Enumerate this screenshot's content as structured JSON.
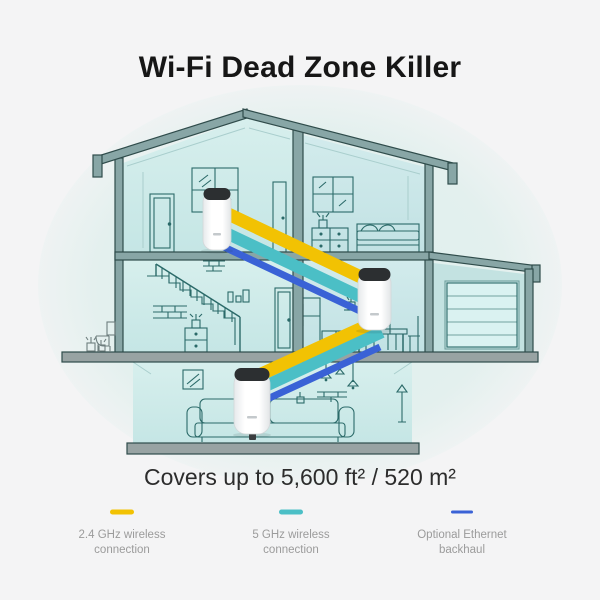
{
  "title": "Wi-Fi Dead Zone Killer",
  "coverage_text": "Covers up to 5,600 ft² / 520 m²",
  "colors": {
    "background": "#f4f4f5",
    "band_24ghz": "#F2C203",
    "band_5ghz": "#4BBFC6",
    "band_ethernet": "#3A62D6",
    "structure": "#88a6a6",
    "line_art": "#2b6a69"
  },
  "legend": {
    "items": [
      {
        "line1": "2.4 GHz wireless",
        "line2": "connection"
      },
      {
        "line1": "5 GHz wireless",
        "line2": "connection"
      },
      {
        "line1": "Optional Ethernet",
        "line2": "backhaul"
      }
    ]
  },
  "illustration": {
    "device_count": 3
  }
}
